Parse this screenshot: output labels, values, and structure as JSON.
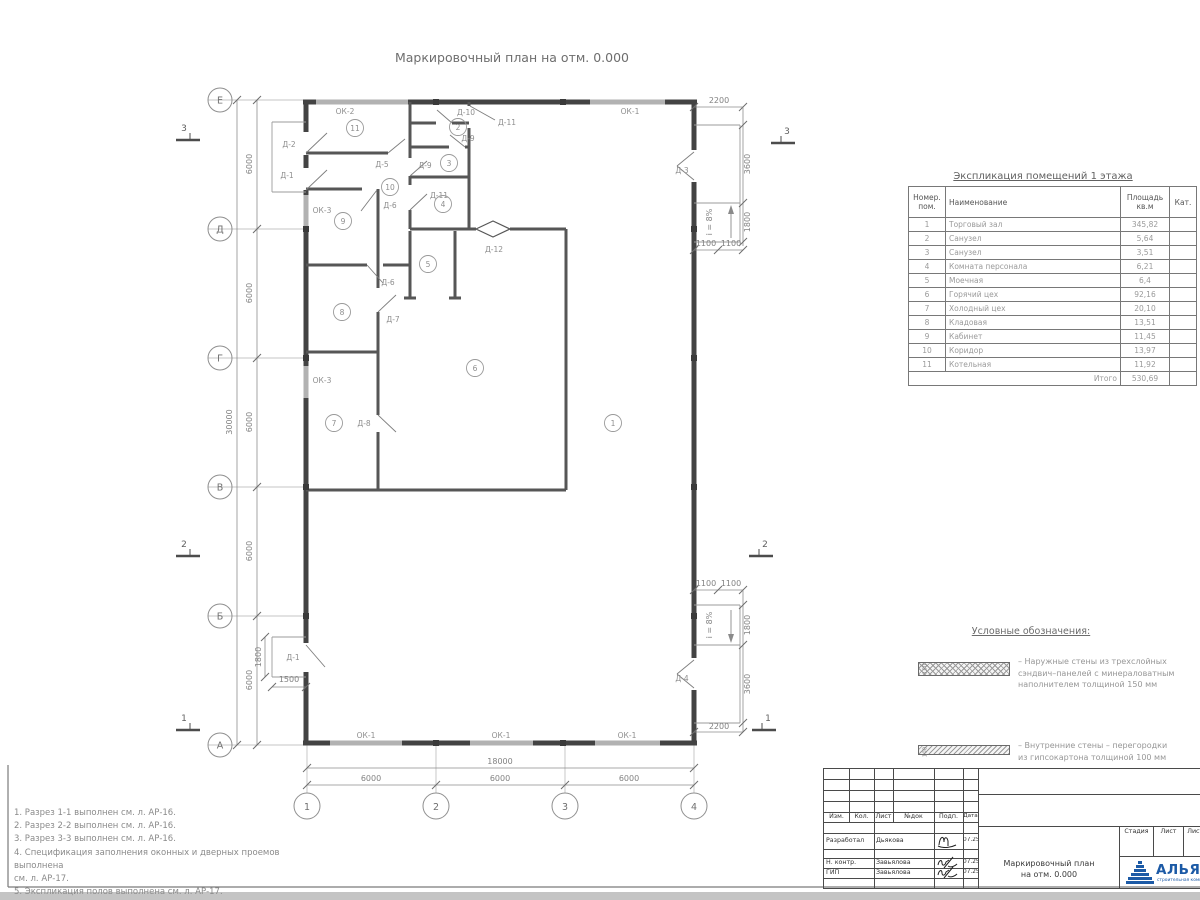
{
  "plan": {
    "title": "Маркировочный план на отм. 0.000",
    "row_axes": [
      "Е",
      "Д",
      "Г",
      "В",
      "Б",
      "А"
    ],
    "col_axes": [
      "1",
      "2",
      "3",
      "4"
    ],
    "labels": [
      {
        "t": "ОК-2",
        "x": 345,
        "y": 114
      },
      {
        "t": "ОК-1",
        "x": 630,
        "y": 114
      },
      {
        "t": "ОК-3",
        "x": 322,
        "y": 213
      },
      {
        "t": "ОК-3",
        "x": 322,
        "y": 383
      },
      {
        "t": "ОК-1",
        "x": 366,
        "y": 738
      },
      {
        "t": "ОК-1",
        "x": 501,
        "y": 738
      },
      {
        "t": "ОК-1",
        "x": 627,
        "y": 738
      },
      {
        "t": "Д-2",
        "x": 289,
        "y": 147
      },
      {
        "t": "Д-1",
        "x": 287,
        "y": 178
      },
      {
        "t": "Д-1",
        "x": 293,
        "y": 660
      },
      {
        "t": "Д-3",
        "x": 682,
        "y": 173
      },
      {
        "t": "Д-4",
        "x": 682,
        "y": 681
      },
      {
        "t": "Д-5",
        "x": 382,
        "y": 167
      },
      {
        "t": "Д-6",
        "x": 390,
        "y": 208
      },
      {
        "t": "Д-6",
        "x": 388,
        "y": 285
      },
      {
        "t": "Д-7",
        "x": 393,
        "y": 322
      },
      {
        "t": "Д-8",
        "x": 364,
        "y": 426
      },
      {
        "t": "Д-9",
        "x": 425,
        "y": 168
      },
      {
        "t": "Д-9",
        "x": 468,
        "y": 141
      },
      {
        "t": "Д-10",
        "x": 466,
        "y": 115
      },
      {
        "t": "Д-11",
        "x": 439,
        "y": 198
      },
      {
        "t": "Д-11",
        "x": 507,
        "y": 125
      },
      {
        "t": "Д-12",
        "x": 494,
        "y": 252
      }
    ],
    "rooms": [
      {
        "n": "1",
        "x": 613,
        "y": 423
      },
      {
        "n": "2",
        "x": 458,
        "y": 127
      },
      {
        "n": "3",
        "x": 449,
        "y": 163
      },
      {
        "n": "4",
        "x": 443,
        "y": 204
      },
      {
        "n": "5",
        "x": 428,
        "y": 264
      },
      {
        "n": "6",
        "x": 475,
        "y": 368
      },
      {
        "n": "7",
        "x": 334,
        "y": 423
      },
      {
        "n": "8",
        "x": 342,
        "y": 312
      },
      {
        "n": "9",
        "x": 343,
        "y": 221
      },
      {
        "n": "10",
        "x": 390,
        "y": 187
      },
      {
        "n": "11",
        "x": 355,
        "y": 128
      }
    ],
    "dims": [
      {
        "t": "6000",
        "x": 252,
        "y": 164,
        "r": -90
      },
      {
        "t": "6000",
        "x": 252,
        "y": 293,
        "r": -90
      },
      {
        "t": "6000",
        "x": 252,
        "y": 422,
        "r": -90
      },
      {
        "t": "6000",
        "x": 252,
        "y": 551,
        "r": -90
      },
      {
        "t": "6000",
        "x": 252,
        "y": 680,
        "r": -90
      },
      {
        "t": "30000",
        "x": 232,
        "y": 422,
        "r": -90
      },
      {
        "t": "18000",
        "x": 500,
        "y": 764,
        "r": 0
      },
      {
        "t": "6000",
        "x": 371,
        "y": 781,
        "r": 0
      },
      {
        "t": "6000",
        "x": 500,
        "y": 781,
        "r": 0
      },
      {
        "t": "6000",
        "x": 629,
        "y": 781,
        "r": 0
      },
      {
        "t": "2200",
        "x": 719,
        "y": 103,
        "r": 0
      },
      {
        "t": "3600",
        "x": 750,
        "y": 164,
        "r": -90
      },
      {
        "t": "1800",
        "x": 750,
        "y": 222,
        "r": -90
      },
      {
        "t": "1100",
        "x": 706,
        "y": 246,
        "r": 0
      },
      {
        "t": "1100",
        "x": 731,
        "y": 246,
        "r": 0
      },
      {
        "t": "1100",
        "x": 706,
        "y": 586,
        "r": 0
      },
      {
        "t": "1100",
        "x": 731,
        "y": 586,
        "r": 0
      },
      {
        "t": "1800",
        "x": 750,
        "y": 625,
        "r": -90
      },
      {
        "t": "3600",
        "x": 750,
        "y": 684,
        "r": -90
      },
      {
        "t": "2200",
        "x": 719,
        "y": 729,
        "r": 0
      },
      {
        "t": "1800",
        "x": 261,
        "y": 657,
        "r": -90
      },
      {
        "t": "1500",
        "x": 289,
        "y": 682,
        "r": 0
      },
      {
        "t": "i = 8%",
        "x": 712,
        "y": 222,
        "r": -90
      },
      {
        "t": "i = 8%",
        "x": 712,
        "y": 625,
        "r": -90
      }
    ],
    "sections": [
      {
        "t": "3",
        "x": 184,
        "y": 131,
        "side": "L"
      },
      {
        "t": "3",
        "x": 787,
        "y": 134,
        "side": "R"
      },
      {
        "t": "2",
        "x": 184,
        "y": 547,
        "side": "L"
      },
      {
        "t": "2",
        "x": 765,
        "y": 547,
        "side": "R"
      },
      {
        "t": "1",
        "x": 184,
        "y": 721,
        "side": "L"
      },
      {
        "t": "1",
        "x": 768,
        "y": 721,
        "side": "R"
      }
    ]
  },
  "explication": {
    "title": "Экспликация помещений 1 этажа",
    "headers": {
      "num": "Номер.\nпом.",
      "name": "Наименование",
      "area": "Площадь\nкв.м",
      "cat": "Кат."
    },
    "rows": [
      {
        "num": "1",
        "name": "Торговый зал",
        "area": "345,82",
        "cat": ""
      },
      {
        "num": "2",
        "name": "Санузел",
        "area": "5,64",
        "cat": ""
      },
      {
        "num": "3",
        "name": "Санузел",
        "area": "3,51",
        "cat": ""
      },
      {
        "num": "4",
        "name": "Комната персонала",
        "area": "6,21",
        "cat": ""
      },
      {
        "num": "5",
        "name": "Моечная",
        "area": "6,4",
        "cat": ""
      },
      {
        "num": "6",
        "name": "Горячий цех",
        "area": "92,16",
        "cat": ""
      },
      {
        "num": "7",
        "name": "Холодный цех",
        "area": "20,10",
        "cat": ""
      },
      {
        "num": "8",
        "name": "Кладовая",
        "area": "13,51",
        "cat": ""
      },
      {
        "num": "9",
        "name": "Кабинет",
        "area": "11,45",
        "cat": ""
      },
      {
        "num": "10",
        "name": "Коридор",
        "area": "13,97",
        "cat": ""
      },
      {
        "num": "11",
        "name": "Котельная",
        "area": "11,92",
        "cat": ""
      }
    ],
    "total_label": "Итого",
    "total": "530,69"
  },
  "legend": {
    "title": "Условные обозначения:",
    "items": [
      {
        "dim": "150",
        "lines": [
          "– Наружные стены из трехслойных",
          "сэндвич–панелей с минераловатным",
          "наполнителем толщиной 150 мм"
        ]
      },
      {
        "dim": "100",
        "lines": [
          "– Внутренние стены – перегородки",
          "из гипсокартона толщиной 100 мм"
        ]
      }
    ]
  },
  "notes": {
    "lines": [
      "1. Разрез 1-1 выполнен см. л. АР-16.",
      "2. Разрез 2-2 выполнен см. л. АР-16.",
      "3. Разрез 3-3 выполнен см. л. АР-16.",
      "4. Спецификация заполнения оконных и дверных проемов выполнена",
      "см. л. АР-17.",
      "5. Экспликация полов выполнена см. л. АР-17."
    ]
  },
  "titleblock": {
    "cols": [
      "Изм.",
      "Кол.",
      "Лист",
      "№док",
      "Подп.",
      "Дата"
    ],
    "rows": [
      {
        "role": "Разработал",
        "name": "Дьякова",
        "date": "07.25"
      },
      {
        "role": "Н. контр.",
        "name": "Завьялова",
        "date": "07.25"
      },
      {
        "role": "ГИП",
        "name": "Завьялова",
        "date": "07.25"
      }
    ],
    "doc_line1": "Маркировочный план",
    "doc_line2": "на отм. 0.000",
    "stage": [
      "Стадия",
      "Лист",
      "Листов"
    ],
    "logo": "АЛЬЯНС",
    "logo_sub": "строительная компания",
    "logo_color": "#1c5aa6"
  }
}
